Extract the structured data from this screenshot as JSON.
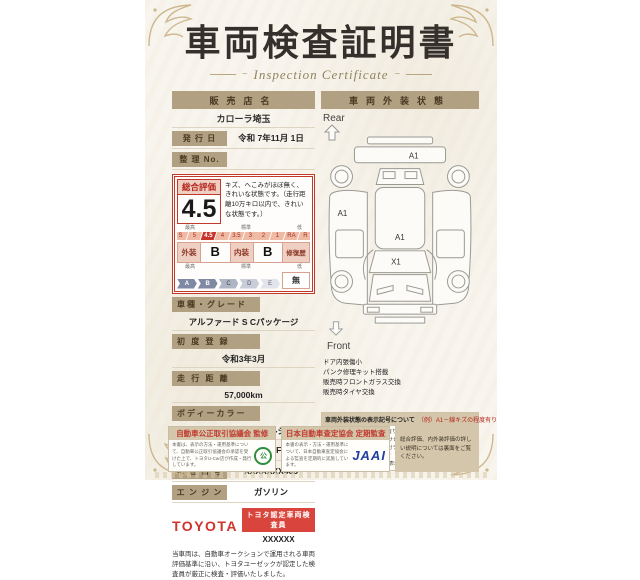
{
  "certificate": {
    "title": "車両検査証明書",
    "subtitle": "Inspection Certificate"
  },
  "dealer": {
    "label": "販売店名",
    "value": "カローラ埼玉",
    "issue_label": "発 行 日",
    "issue_value": "令和 7年11月 1日",
    "ref_label": "整 理 No.",
    "ref_value": ""
  },
  "rating": {
    "label": "総合評価",
    "score": "4.5",
    "comment": "キズ、へこみがほぼ無く、きれいな状態です。（走行距離10万キロ以内で、きれいな状態です。）",
    "scale_labels": {
      "high": "最高",
      "mid": "標準",
      "low": "低"
    },
    "scale": [
      "S",
      "5",
      "4.5",
      "4",
      "3.5",
      "3",
      "2",
      "1",
      "RA",
      "R"
    ],
    "selected": "4.5",
    "exterior_label": "外装",
    "exterior_grade": "B",
    "interior_label": "内装",
    "interior_grade": "B",
    "repair_label": "修復歴",
    "repair_value": "無",
    "grade_scale": [
      "A",
      "B",
      "C",
      "D",
      "E"
    ],
    "grade_labels": {
      "high": "最高",
      "mid": "標準",
      "low": "低"
    }
  },
  "fields": [
    {
      "label": "車種・グレード",
      "value": "アルファード S Cパッケージ"
    },
    {
      "label": "初 度 登 録",
      "value": "令和3年3月"
    },
    {
      "label": "走 行 距 離",
      "value": "57,000km"
    },
    {
      "label": "ボディーカラー",
      "value": "ホワイトパールクリスタルシャイン"
    },
    {
      "label": "型　　式",
      "value": "AGH30W-PFXSK(C)"
    },
    {
      "label": "車 台 番 号",
      "value": "XXXXXXX403"
    },
    {
      "label": "エ ン ジ ン",
      "value": "ガソリン"
    }
  ],
  "toyota": {
    "logo": "TOYOTA",
    "badge": "トヨタ認定車両検査員",
    "inspector_id": "XXXXXX"
  },
  "disclaimer": "当車両は、自動車オークションで運用される車両評価基準に沿い、トヨタユーゼックが認定した検査員が厳正に検査・評価いたしました。",
  "exterior": {
    "header": "車両外装状態",
    "rear_label": "Rear",
    "front_label": "Front",
    "markers": [
      "A1",
      "A1",
      "A1",
      "X1"
    ],
    "notes": [
      "ドア内張傷小",
      "パンク修理キット搭載",
      "販売時フロントガラス交換",
      "販売時タイヤ交換"
    ],
    "legend_header": "車両外装状態の表示記号について",
    "legend_example": "（例）A1－線キズの程度有り",
    "legend_lines": [
      "A－線キズ有り　U－へこみ有り　B－へこみとキズ有り　P－塗装待ち　W－補修跡有り　S－サビ有り",
      "C－腐食有り　G－フロントガラスキズ有り　X－要交換　XX－交換済　1－小程度　2－中程度　3－中程度以上",
      "※タイヤ等の消耗品は、別に表示をいたします。"
    ]
  },
  "footer": {
    "box1_header": "自動車公正取引協議会 監修",
    "box1_text": "本書は、表示の方法・運用基準について、自動車公正取引協議会の承認を受けた上で、トヨタU-Car店が作成・発行しています。",
    "box2_header": "日本自動車査定協会 定期監査",
    "box2_text": "本書の表示・方法・運用基準について、日本自動車査定協会による監査を定期的に実施しています。",
    "box2_logo": "JAAI",
    "box3_text": "総合評価、内外装評価の詳しい説明については裏面をご覧ください。"
  },
  "colors": {
    "paper": "#f8f5ee",
    "tan_bar": "#b2a082",
    "red_accent": "#c7342c",
    "toyota_red": "#d0342c",
    "jaai_blue": "#1f3f9e",
    "eco_green": "#2d8f3c"
  }
}
